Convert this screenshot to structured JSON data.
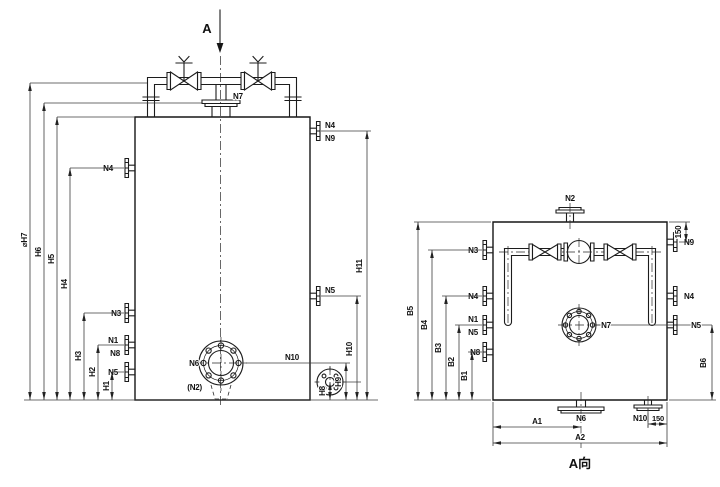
{
  "drawing": {
    "background_color": "#ffffff",
    "line_color": "#1c1c1c",
    "type": "vessel-nozzle-orientation-drawing"
  },
  "front_view": {
    "view_arrow": "A",
    "nozzles": {
      "n7": "N7",
      "n4_left": "N4",
      "n4_right": "N4",
      "n9": "N9",
      "n3": "N3",
      "n1": "N1",
      "n8": "N8",
      "n5_left": "N5",
      "n5_right": "N5",
      "n6": "N6",
      "n2_hidden": "(N2)",
      "n10": "N10"
    },
    "dims": {
      "h1": "H1",
      "h2": "H2",
      "h3": "H3",
      "h4": "H4",
      "h5": "H5",
      "h6": "H6",
      "h7": "⌀H7",
      "h8": "H8",
      "h9": "H9",
      "h10": "H10",
      "h11": "H11"
    }
  },
  "side_view": {
    "title": "A向",
    "nozzles": {
      "n2": "N2",
      "n3": "N3",
      "n4_left": "N4",
      "n1": "N1",
      "n5_left": "N5",
      "n8": "N8",
      "n9": "N9",
      "n4_right": "N4",
      "n5_right": "N5",
      "n7": "N7",
      "n6": "N6",
      "n10": "N10"
    },
    "dims": {
      "b1": "B1",
      "b2": "B2",
      "b3": "B3",
      "b4": "B4",
      "b5": "B5",
      "b6": "B6",
      "a1": "A1",
      "a2": "A2",
      "offset_top_right": "150",
      "offset_bottom_right": "150"
    }
  }
}
